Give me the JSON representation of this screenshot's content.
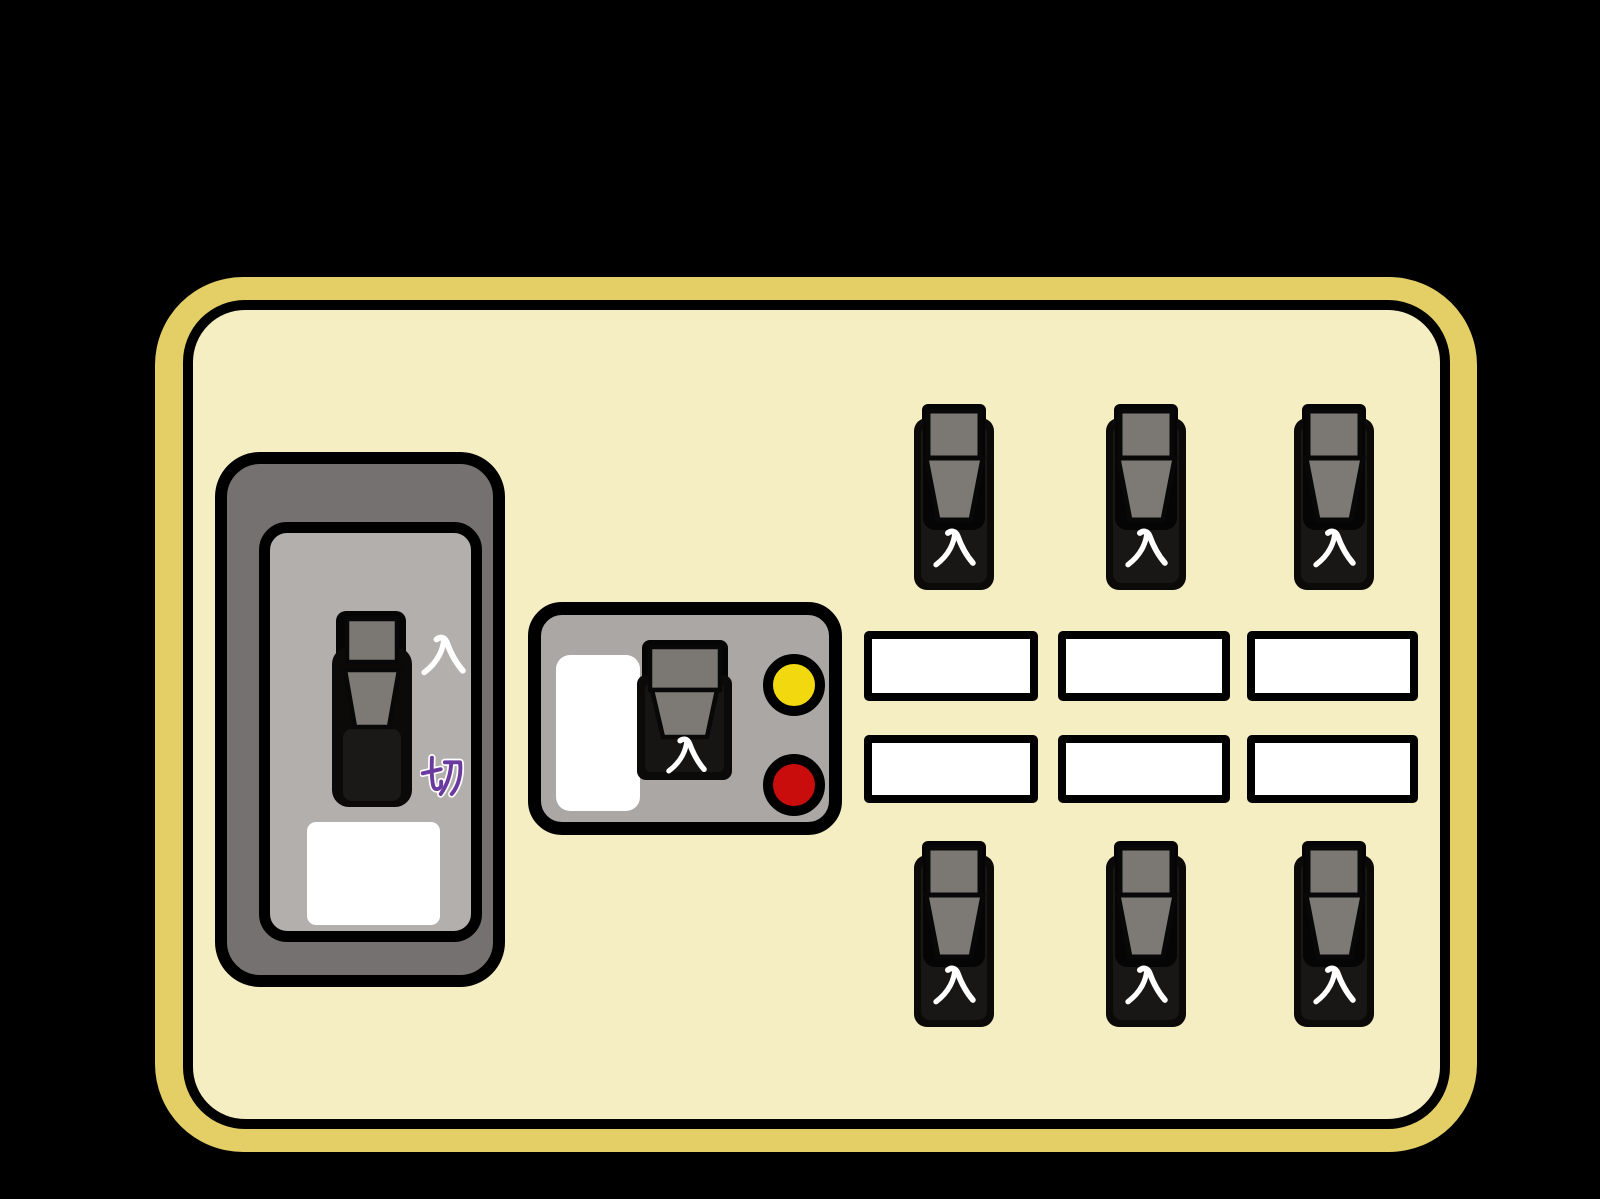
{
  "window": {
    "background_color": "#000000"
  },
  "panel": {
    "frame_color": "#e4ce66",
    "surface_color": "#f6eec3",
    "outline_color": "#000000"
  },
  "main_breaker": {
    "state": "on",
    "on_label": "入",
    "off_label": "切",
    "on_label_color": "#ffffff",
    "off_label_color": "#6b3a9e",
    "label_plate_text": "",
    "body_color": "#757170",
    "face_color": "#b2afac",
    "handle_color": "#7b7773"
  },
  "leakage_breaker": {
    "state": "on",
    "on_label": "入",
    "label_plate_text": "",
    "body_color": "#aaa7a5",
    "indicator_lamp_color": "#f2d80e",
    "test_button_color": "#c90d0d",
    "handle_color": "#7b7773"
  },
  "branch_breakers": {
    "body_color": "#0c0a09",
    "handle_color": "#7b7773",
    "rows": [
      {
        "items": [
          {
            "state": "on",
            "on_label": "入"
          },
          {
            "state": "on",
            "on_label": "入"
          },
          {
            "state": "on",
            "on_label": "入"
          }
        ]
      },
      {
        "items": [
          {
            "state": "on",
            "on_label": "入"
          },
          {
            "state": "on",
            "on_label": "入"
          },
          {
            "state": "on",
            "on_label": "入"
          }
        ]
      }
    ]
  },
  "label_plates": {
    "rows": 2,
    "columns": 3,
    "fill_color": "#ffffff",
    "texts": [
      "",
      "",
      "",
      "",
      "",
      ""
    ]
  }
}
